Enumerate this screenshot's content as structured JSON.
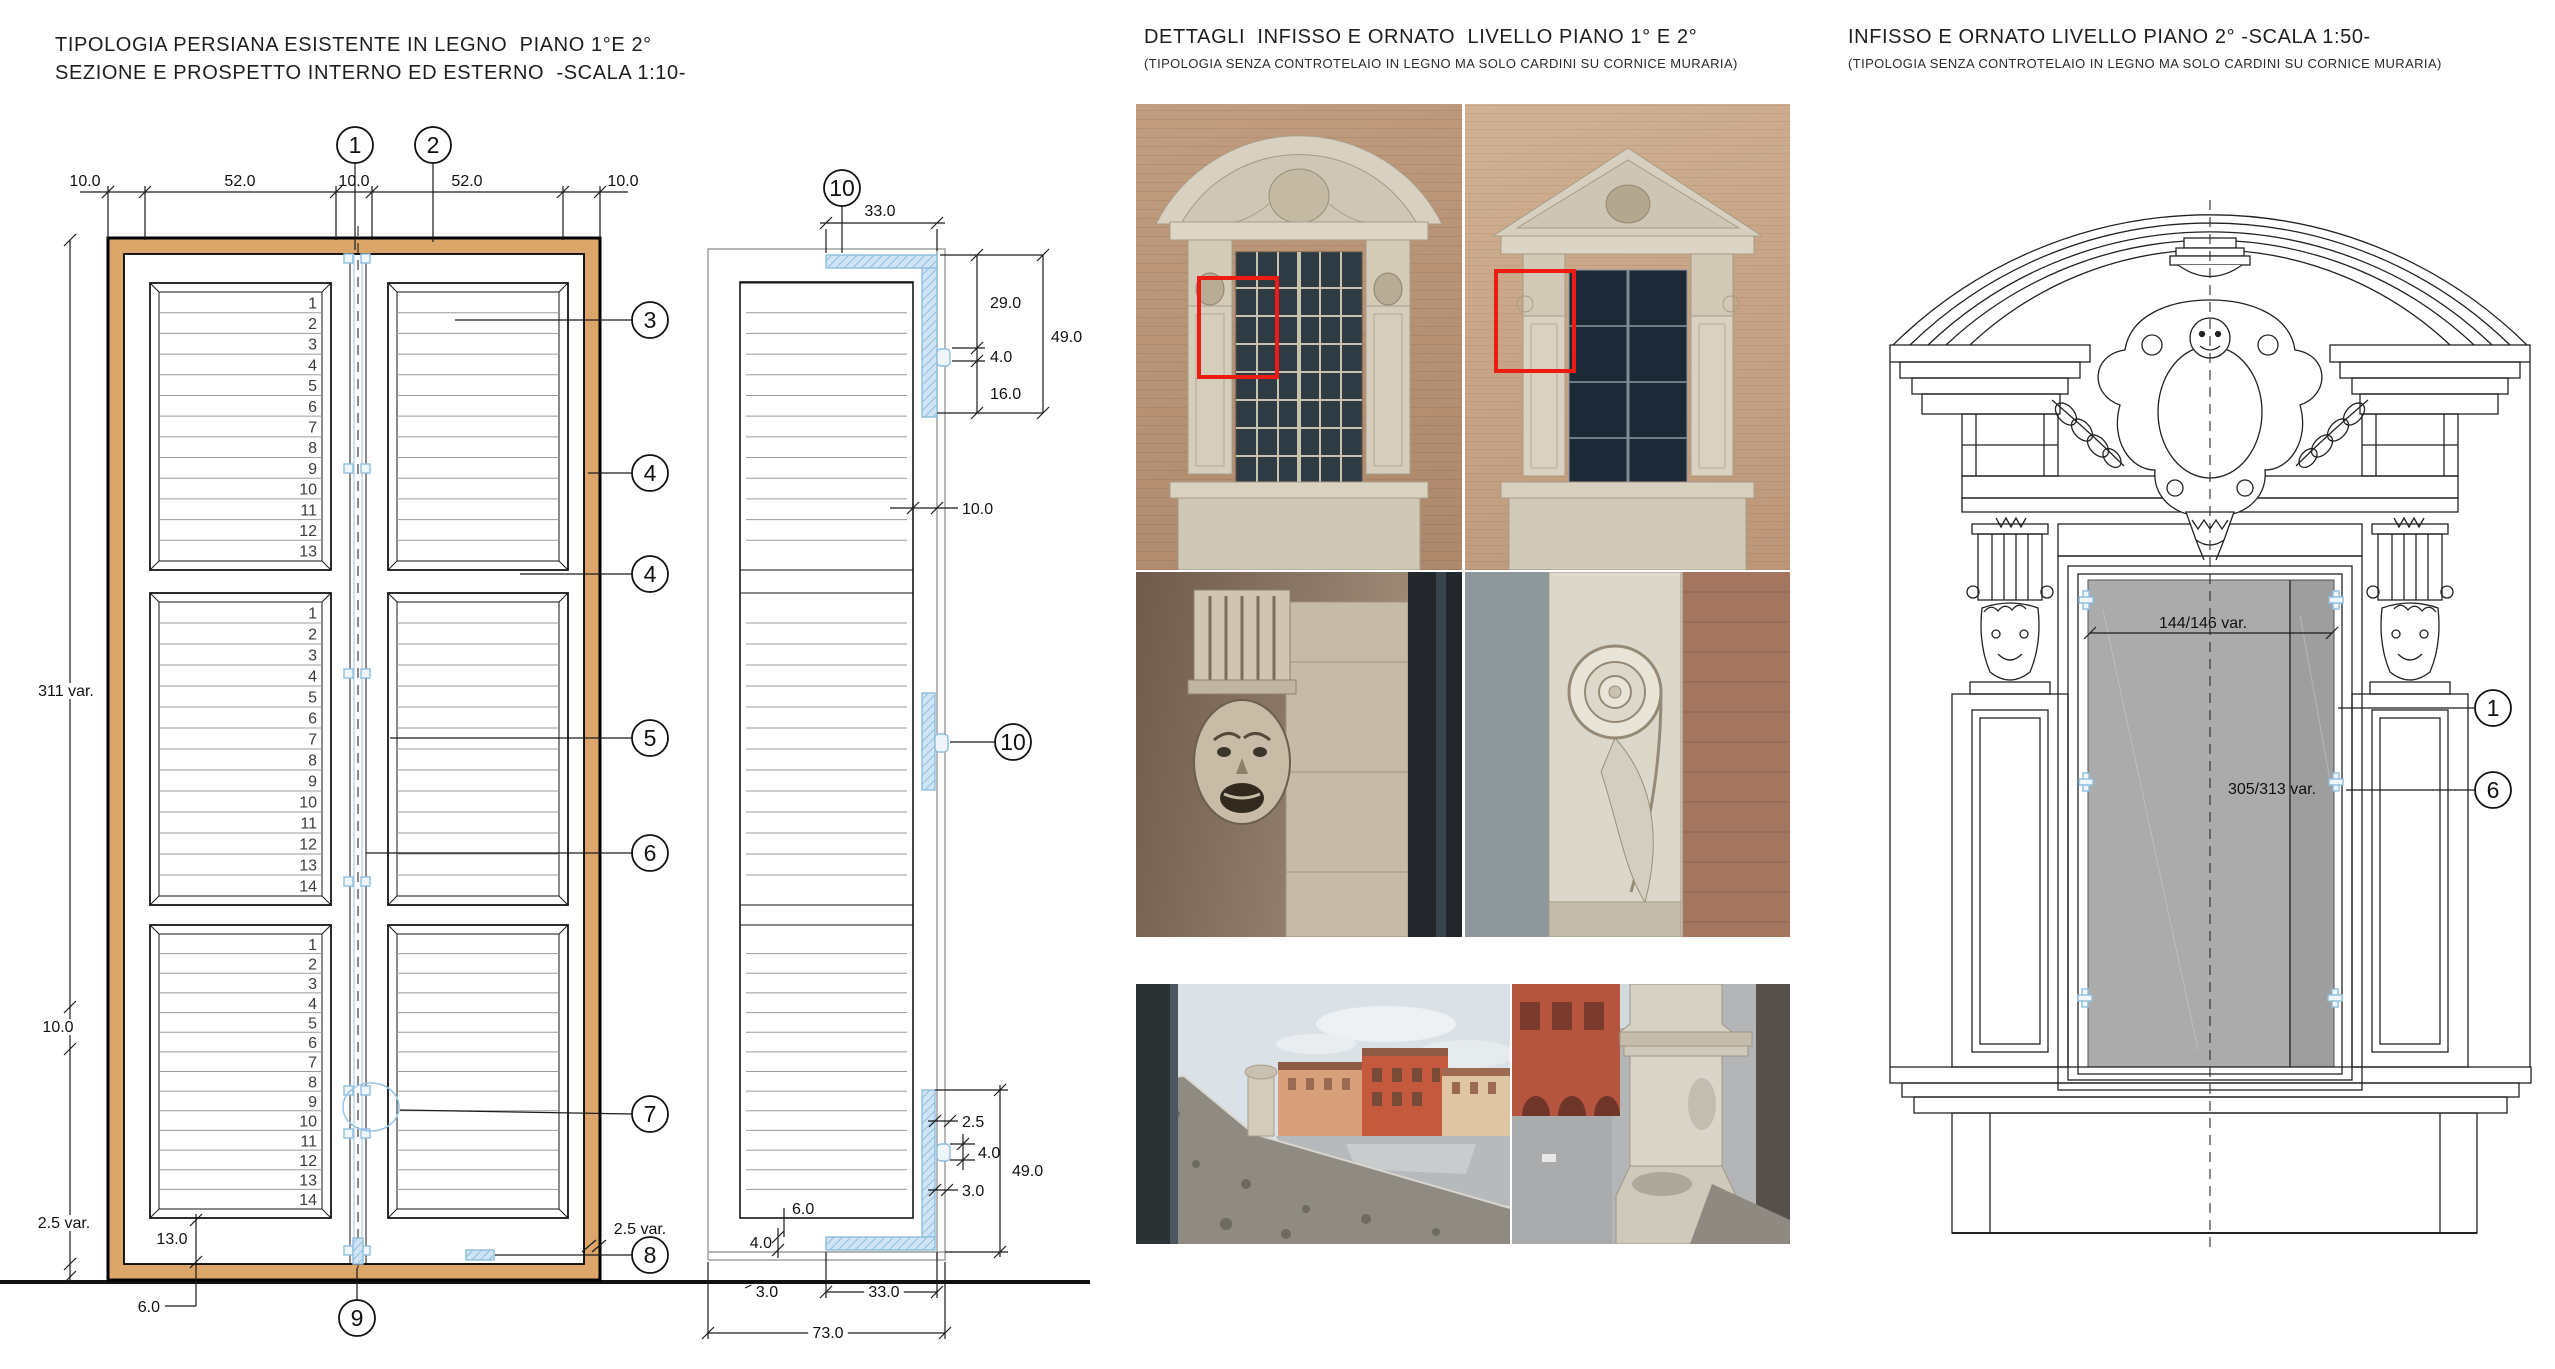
{
  "colors": {
    "wood": "#dca569",
    "hatch_fill": "#cfe4f5",
    "hatch_line": "#8fbede",
    "hinge_blue": "#9cc6e8",
    "highlight_red": "#ec1c12",
    "opening_gray": "#ababab"
  },
  "left_panel": {
    "title_line1": "TIPOLOGIA PERSIANA ESISTENTE IN LEGNO  PIANO 1°E 2°",
    "title_line2": "SEZIONE E PROSPETTO INTERNO ED ESTERNO  -SCALA 1:10-",
    "elevation": {
      "top_dims": [
        "10.0",
        "52.0",
        "10.0",
        "52.0",
        "10.0"
      ],
      "height_dim": "311 var.",
      "rail_dim": "10.0",
      "bottom_band_dim": "2.5 var.",
      "bottom_band_dim_right": "2.5 var.",
      "bottom_rail_dim": "13.0",
      "bottom_offset_dim": "6.0",
      "slat_counts": [
        13,
        14,
        14
      ],
      "markers": [
        "1",
        "2",
        "3",
        "4",
        "4",
        "5",
        "6",
        "7",
        "8",
        "9"
      ]
    },
    "section_view": {
      "markers": [
        "10",
        "10"
      ],
      "top_width_dim": "33.0",
      "right_top_dims": [
        "29.0",
        "4.0",
        "16.0",
        "49.0"
      ],
      "gap_dim": "10.0",
      "right_bottom_dims": [
        "2.5",
        "4.0",
        "3.0",
        "49.0"
      ],
      "bottom_left_dims": [
        "6.0",
        "4.0"
      ],
      "bottom_dims": [
        "3.0",
        "33.0",
        "73.0"
      ]
    }
  },
  "middle_panel": {
    "title": "DETTAGLI  INFISSO E ORNATO  LIVELLO PIANO 1° E 2°",
    "subtitle": "(TIPOLOGIA SENZA CONTROTELAIO IN LEGNO MA SOLO CARDINI SU CORNICE MURARIA)"
  },
  "right_panel": {
    "title": "INFISSO E ORNATO LIVELLO PIANO 2° -SCALA 1:50-",
    "subtitle": "(TIPOLOGIA SENZA CONTROTELAIO IN LEGNO MA SOLO CARDINI SU CORNICE MURARIA)",
    "ornato": {
      "width_dim": "144/146 var.",
      "height_dim": "305/313 var.",
      "markers": [
        "1",
        "6"
      ]
    }
  }
}
